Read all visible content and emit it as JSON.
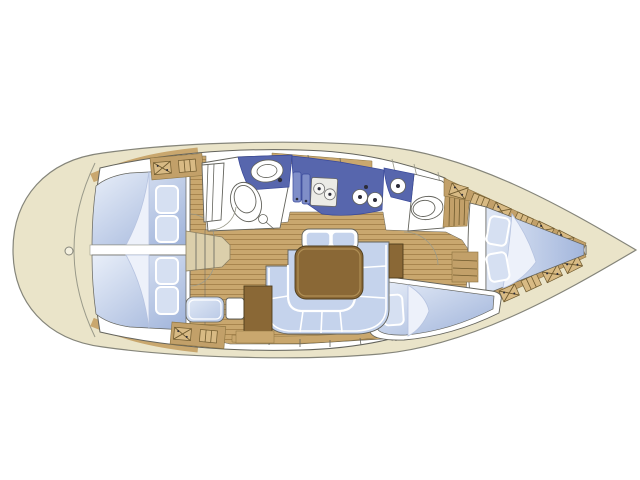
{
  "image": {
    "title": "Sailing yacht interior layout plan, top view",
    "type": "boat deck / accommodation plan"
  },
  "palette": {
    "background": "#ffffff",
    "hull_fill": "#eae4c9",
    "hull_outline": "#85857a",
    "deck_line": "#9a9a8a",
    "wood": "#c9a76e",
    "wood_dark": "#a8854e",
    "wood_band": "#c2a069",
    "wood_edge": "#8b7340",
    "furniture": "#8a6836",
    "furniture_edge": "#4e3d1c",
    "counter": "#5766ad",
    "counter_light": "#7f8ec8",
    "counter_edge": "#39499a",
    "cushion": "#c5d3ec",
    "pillow": "#d6e0f2",
    "blanket": "#edf1fa",
    "berth_light": "#e9eff9",
    "berth_mid": "#9fb3da",
    "white": "#ffffff",
    "outline": "#63635c",
    "steps": "#dbcfab",
    "dark_dot": "#2c2c38"
  },
  "areas": {
    "stern_deck": "rounded stern deck",
    "aft_cabin_upper": "aft double cabin (2 pillows)",
    "aft_cabin_lower": "aft double cabin (2 pillows)",
    "companionway": "companionway steps",
    "aft_head": "aft head with toilet, basin and shower",
    "wardrobe": "wardrobe locker",
    "galley": "galley with fridge, 2-burner stove and twin round sinks",
    "saloon": "saloon with U-shaped settee, table and forward bench",
    "nav_station": "chart table with navigator seat",
    "forward_head": "forward head with toilet and basin",
    "side_berth": "forward side berth (1 pillow)",
    "forward_cabin": "bow V-berth cabin (2 pillows)",
    "shelves": "hull-side stowage shelves with strapped lockers",
    "bow_peak": "bow anchor locker"
  }
}
